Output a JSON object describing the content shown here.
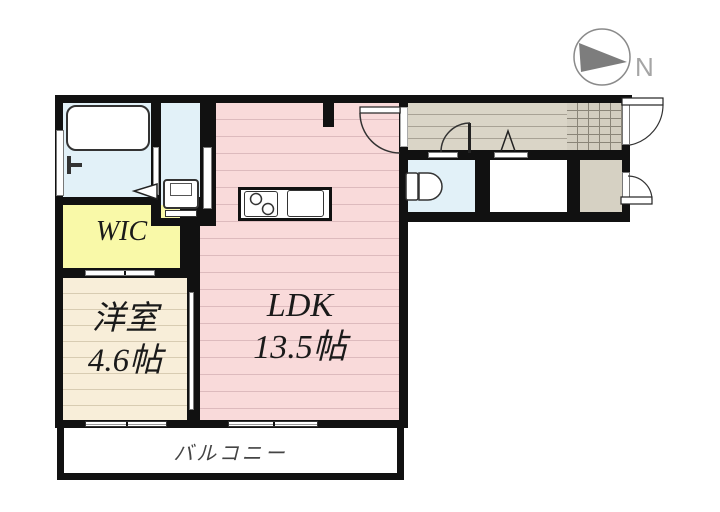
{
  "compass": {
    "label": "N"
  },
  "rooms": {
    "wic": {
      "label": "WIC"
    },
    "bedroom": {
      "name": "洋室",
      "size": "4.6帖"
    },
    "ldk": {
      "name": "LDK",
      "size": "13.5帖"
    },
    "balcony": {
      "label": "バルコニー"
    }
  },
  "colors": {
    "wall": "#111111",
    "wet_area": "#e2f1f8",
    "ldk_floor": "#f9dada",
    "ldk_stripe": "#ddbabd",
    "bedroom_floor": "#f8eed9",
    "bedroom_stripe": "#d8ccb2",
    "wic_floor": "#f9f9a8",
    "hallway_floor": "#dad5c7",
    "hallway_stripe": "#a8a295",
    "tile_floor": "#d3cec0",
    "storage_floor": "#d6d1c3"
  }
}
